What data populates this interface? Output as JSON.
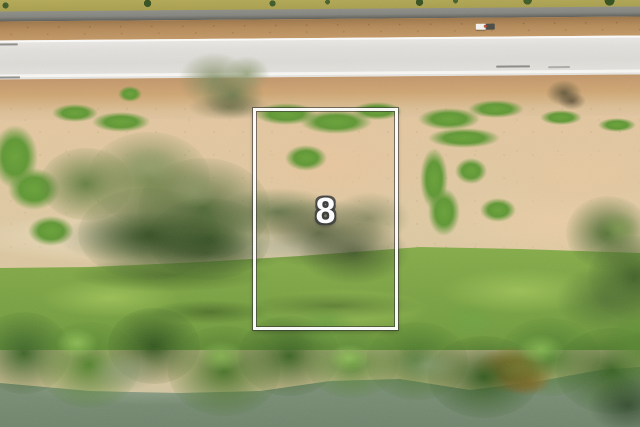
{
  "scene": {
    "type": "aerial-drone-photo",
    "description": "Aerial view of a vacant staked lot between a light concrete road and a tree-lined river bank",
    "lot_marker": {
      "label": "8",
      "text_color": "#ffffff",
      "outline_color": "#3a3a3a"
    },
    "boundary": {
      "line_color": "#ffffff",
      "edge_color": "#2d2d2d"
    },
    "palette": {
      "road": "#e2e0dc",
      "asphalt_strip": "#84847f",
      "dirt_shoulder": "#c89e6e",
      "sand": "#e0c49f",
      "grass": "#7ca443",
      "tree_canopy": "#47742a",
      "water": "#7c9077",
      "orange_bank": "#c2762e"
    }
  }
}
